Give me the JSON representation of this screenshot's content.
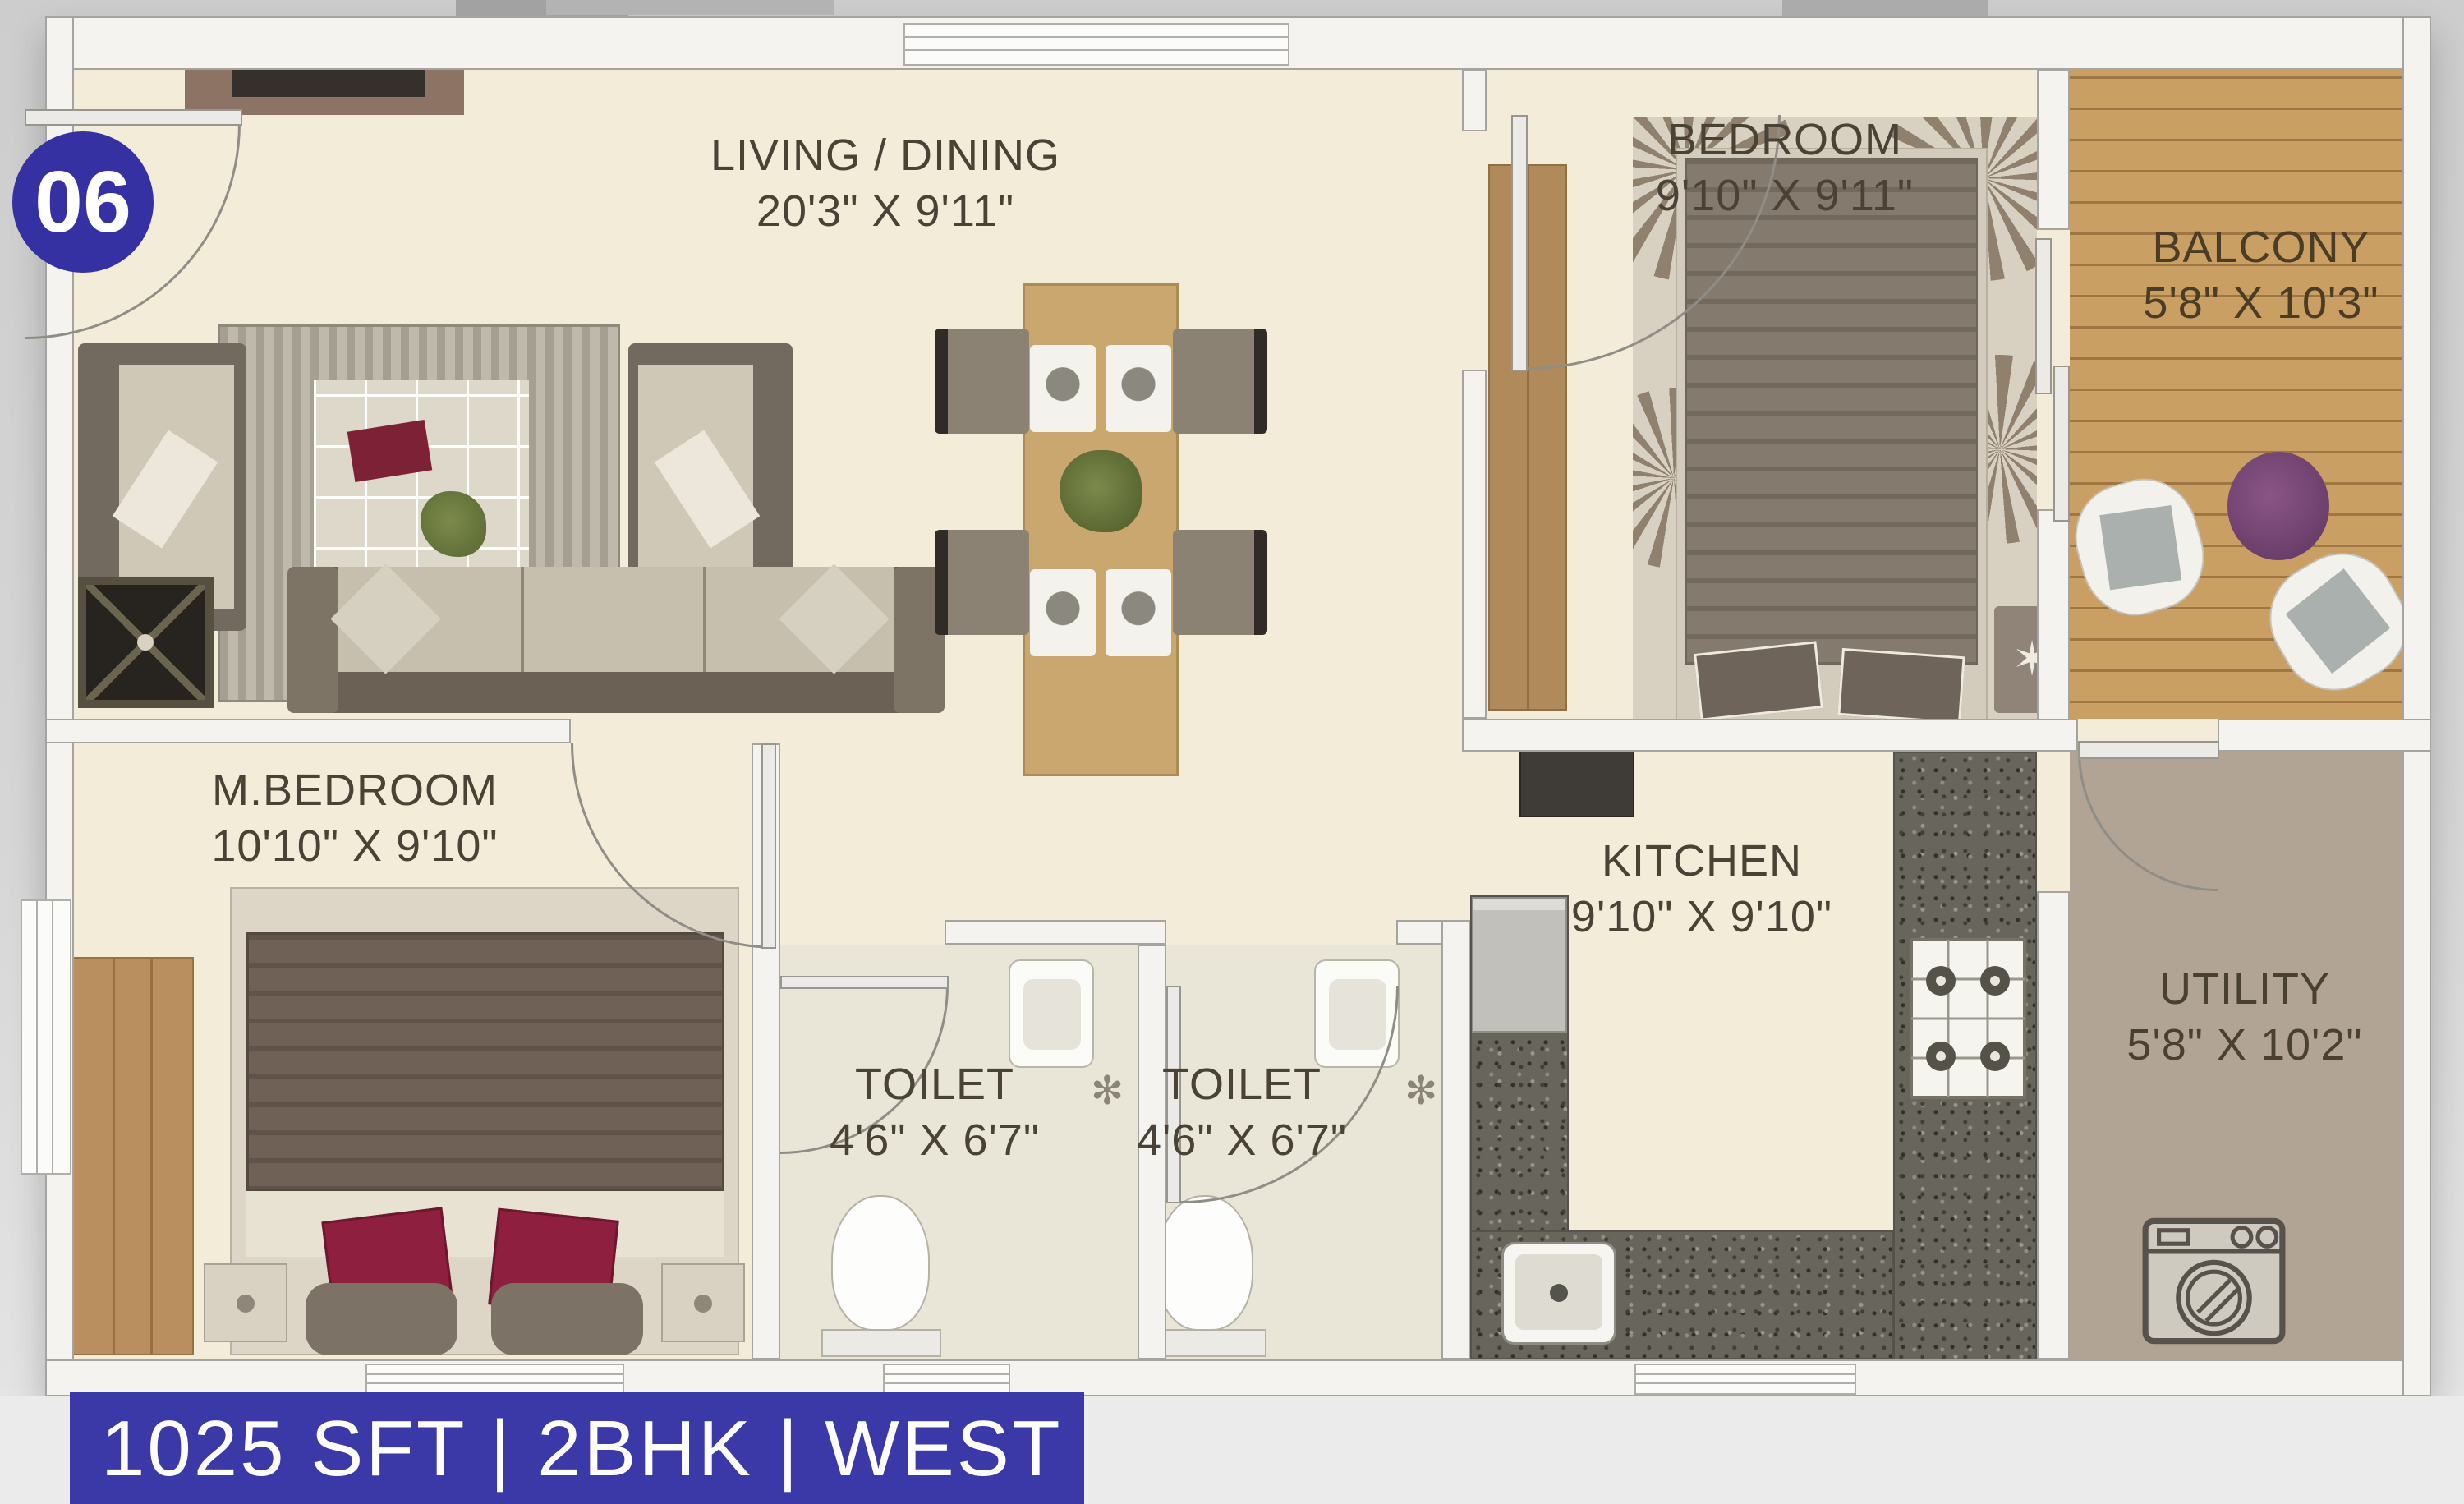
{
  "unit": {
    "badge": "06"
  },
  "banner": {
    "text": "1025 SFT | 2BHK | WEST"
  },
  "rooms": {
    "living_dining": {
      "label": "LIVING / DINING",
      "dims": "20'3\" X 9'11\""
    },
    "bedroom": {
      "label": "BEDROOM",
      "dims": "9'10\" X 9'11\""
    },
    "balcony": {
      "label": "BALCONY",
      "dims": "5'8\" X 10'3\""
    },
    "master_bedroom": {
      "label": "M.BEDROOM",
      "dims": "10'10\" X 9'10\""
    },
    "toilet_1": {
      "label": "TOILET",
      "dims": "4'6\" X 6'7\""
    },
    "toilet_2": {
      "label": "TOILET",
      "dims": "4'6\" X 6'7\""
    },
    "kitchen": {
      "label": "KITCHEN",
      "dims": "9'10\" X 9'10\""
    },
    "utility": {
      "label": "UTILITY",
      "dims": "5'8\" X 10'2\""
    }
  },
  "icons": {
    "star": "✶",
    "flower": "✻"
  },
  "colors": {
    "accent_blue": "#3b38a8",
    "floor_cream": "#f2ecd9",
    "balcony_wood": "#c99f63",
    "granite": "#67655c",
    "utility_floor": "#b2a494",
    "label_text": "#4a4335",
    "pillow_red": "#8e1f3e",
    "pouf_purple": "#7b4573"
  }
}
